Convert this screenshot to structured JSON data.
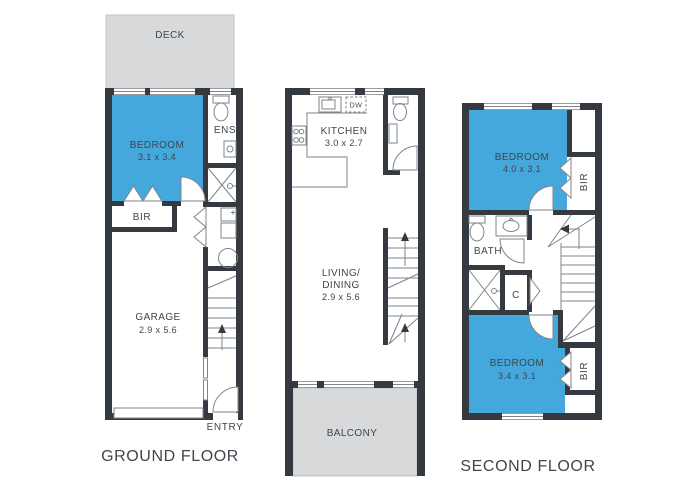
{
  "document": {
    "type": "residential floor plan, three levels"
  },
  "colors": {
    "room_highlight": "#44A8DD",
    "outdoor_area": "#D7D9DA",
    "walls": "#343A40",
    "fixture_lines": "#7F8488",
    "text": "#3F464C",
    "background": "#FFFFFF"
  },
  "ground_floor": {
    "title": "GROUND FLOOR",
    "deck_label": "DECK",
    "bedroom_label": "BEDROOM",
    "bedroom_size": "3.1 x 3.4",
    "bir_label": "BIR",
    "ens_label": "ENS",
    "garage_label": "GARAGE",
    "garage_size": "2.9 x 5.6",
    "entry_label": "ENTRY"
  },
  "first_floor": {
    "kitchen_label": "KITCHEN",
    "kitchen_size": "3.0 x 2.7",
    "dishwasher_label": "DW",
    "living_label_line1": "LIVING/",
    "living_label_line2": "DINING",
    "living_size": "2.9 x 5.6",
    "balcony_label": "BALCONY"
  },
  "second_floor": {
    "title": "SECOND FLOOR",
    "bedroom_front_label": "BEDROOM",
    "bedroom_front_size": "4.0 x 3.1",
    "bir_front_label": "BIR",
    "bath_label": "BATH",
    "closet_label": "C",
    "bedroom_rear_label": "BEDROOM",
    "bedroom_rear_size": "3.4 x 3.1",
    "bir_rear_label": "BIR"
  },
  "fixtures": [
    "toilet",
    "shower",
    "vanity-basin",
    "kitchen-sink",
    "cooktop",
    "dishwasher",
    "laundry-trough",
    "washing-machine",
    "staircase",
    "door-swing",
    "wardrobe-doors",
    "garage-door",
    "window"
  ]
}
